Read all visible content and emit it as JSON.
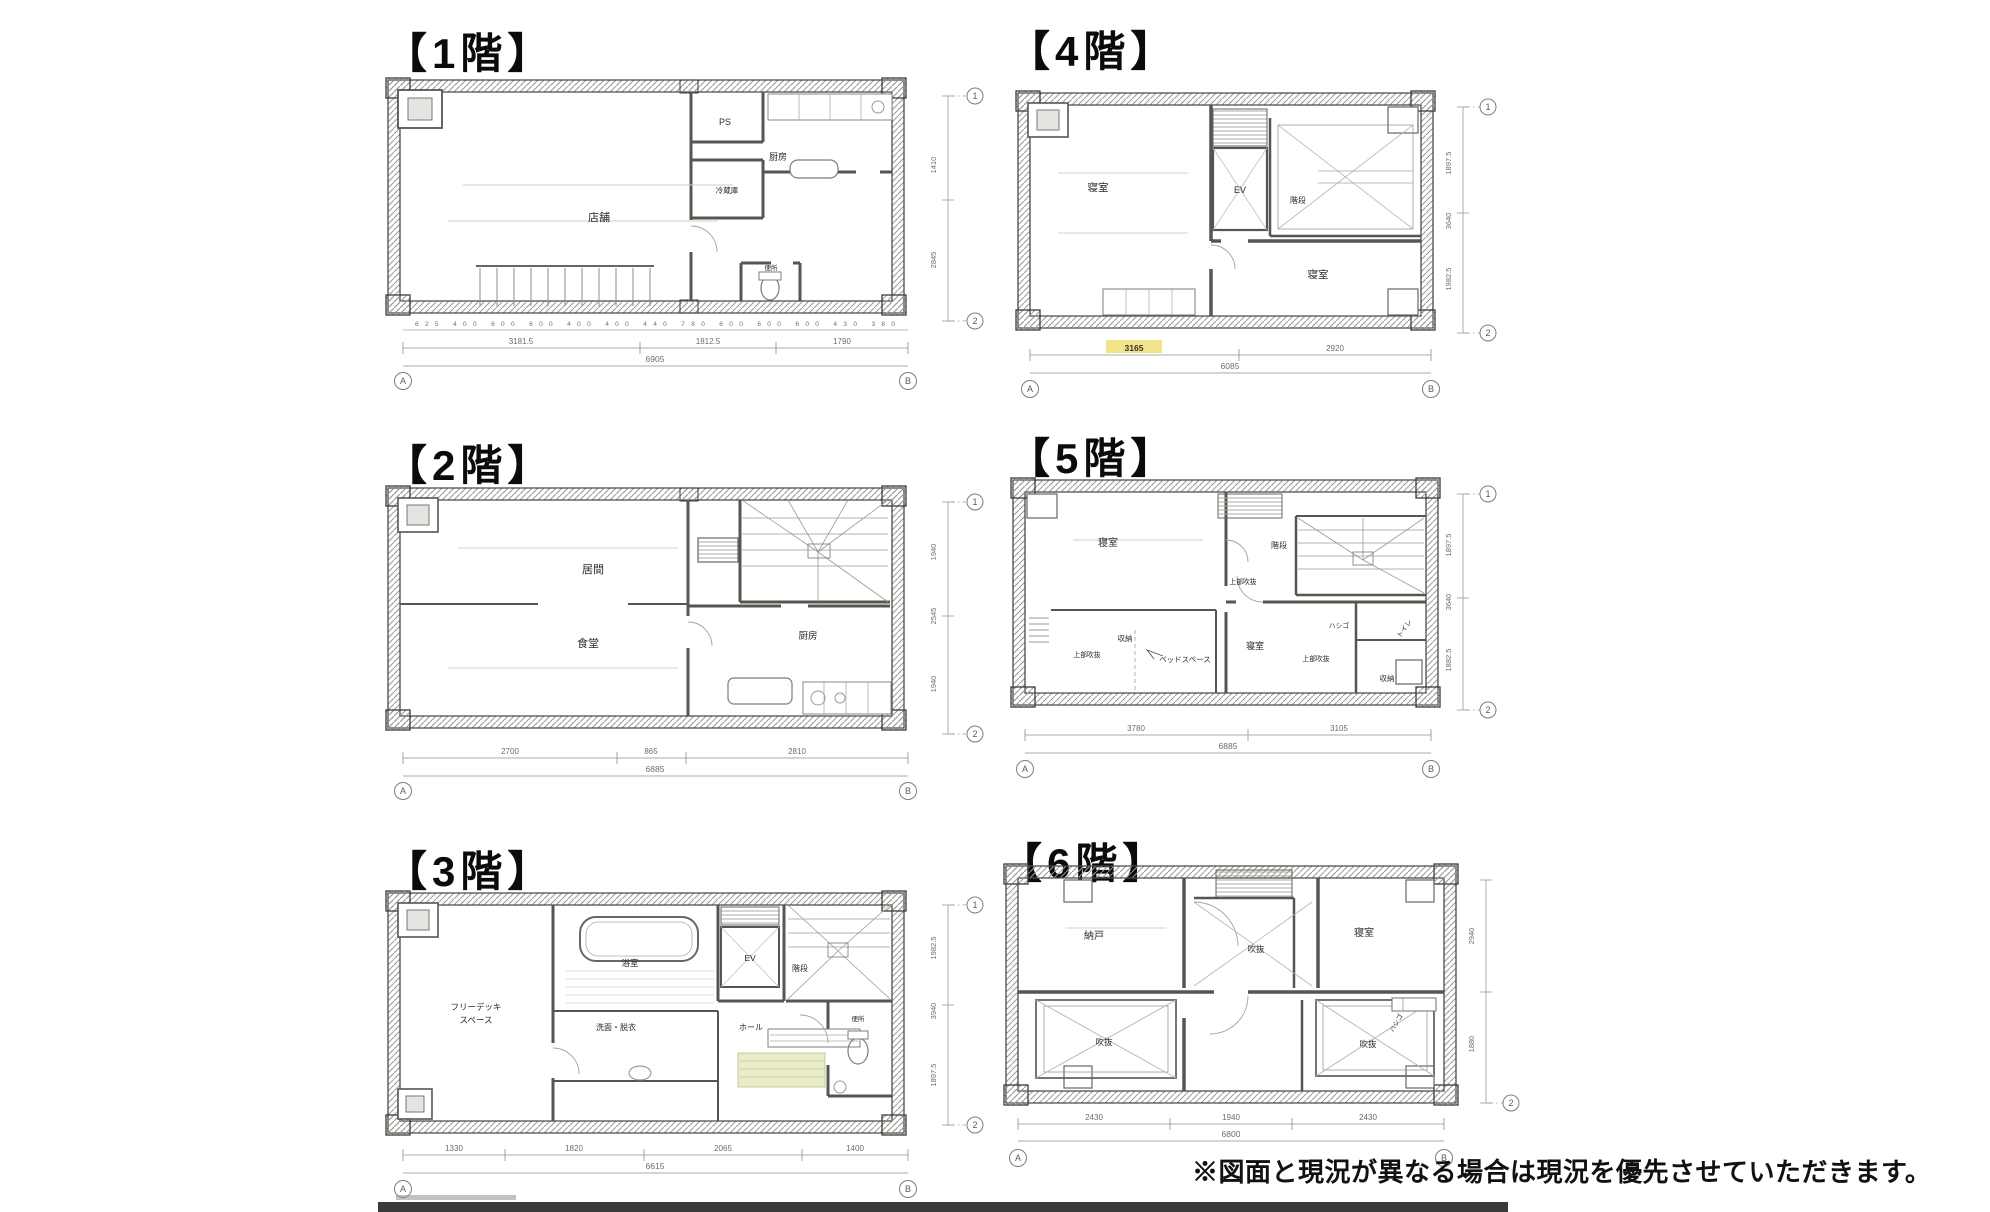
{
  "page": {
    "note": "※図面と現況が異なる場合は現況を優先させていただきます。",
    "highlight_color": "#f0dd76"
  },
  "axis": {
    "a": "A",
    "b": "B",
    "one": "1",
    "two": "2"
  },
  "floors": [
    {
      "id": "1F",
      "title": "【1階】",
      "rooms": [
        {
          "label": "店舗"
        },
        {
          "label": "PS"
        },
        {
          "label": "冷蔵庫"
        },
        {
          "label": "厨房"
        },
        {
          "label": "便所"
        }
      ],
      "dims_bottom": {
        "small": "625 400 600 600 400 400 440 780 600 600 600 430 380",
        "segments": [
          "3181.5",
          "1812.5",
          "1790"
        ],
        "total": "6905"
      },
      "dims_right": [
        "1410",
        "2845"
      ]
    },
    {
      "id": "2F",
      "title": "【2階】",
      "rooms": [
        {
          "label": "居間"
        },
        {
          "label": "食堂"
        },
        {
          "label": "厨房"
        }
      ],
      "dims_bottom": {
        "segments": [
          "2700",
          "865",
          "2810"
        ],
        "total": "6885"
      },
      "dims_right": [
        "1940",
        "2545",
        "1940"
      ]
    },
    {
      "id": "3F",
      "title": "【3階】",
      "rooms": [
        {
          "label": "フリーデッキ"
        },
        {
          "label": "スペース"
        },
        {
          "label": "浴室"
        },
        {
          "label": "EV"
        },
        {
          "label": "階段"
        },
        {
          "label": "洗面・脱衣"
        },
        {
          "label": "ホール"
        },
        {
          "label": "便所"
        }
      ],
      "dims_bottom": {
        "segments": [
          "1330",
          "1820",
          "2065",
          "1400"
        ],
        "total": "6615"
      },
      "dims_right": [
        "1982.5",
        "3940",
        "1897.5"
      ]
    },
    {
      "id": "4F",
      "title": "【4階】",
      "rooms": [
        {
          "label": "寝室"
        },
        {
          "label": "EV"
        },
        {
          "label": "階段"
        },
        {
          "label": "寝室"
        }
      ],
      "dims_bottom": {
        "segments": [
          "3165",
          "2920"
        ],
        "total": "6085"
      },
      "dims_right": [
        "1897.5",
        "3640",
        "1982.5"
      ]
    },
    {
      "id": "5F",
      "title": "【5階】",
      "rooms": [
        {
          "label": "寝室"
        },
        {
          "label": "階段"
        },
        {
          "label": "上部吹抜"
        },
        {
          "label": "収納"
        },
        {
          "label": "ベッドスペース"
        },
        {
          "label": "上部吹抜"
        },
        {
          "label": "寝室"
        },
        {
          "label": "上部吹抜"
        },
        {
          "label": "ハシゴ"
        },
        {
          "label": "トイレ"
        },
        {
          "label": "収納"
        }
      ],
      "dims_bottom": {
        "segments": [
          "3780",
          "3105"
        ],
        "total": "6885"
      },
      "dims_right": [
        "1897.5",
        "3640",
        "1882.5"
      ]
    },
    {
      "id": "6F",
      "title": "【6階】",
      "rooms": [
        {
          "label": "納戸"
        },
        {
          "label": "吹抜"
        },
        {
          "label": "寝室"
        },
        {
          "label": "吹抜"
        },
        {
          "label": "吹抜"
        },
        {
          "label": "ハシゴ"
        }
      ],
      "dims_bottom": {
        "segments": [
          "2430",
          "1940",
          "2430"
        ],
        "total": "6800"
      },
      "dims_right": [
        "2940",
        "1880"
      ]
    }
  ]
}
